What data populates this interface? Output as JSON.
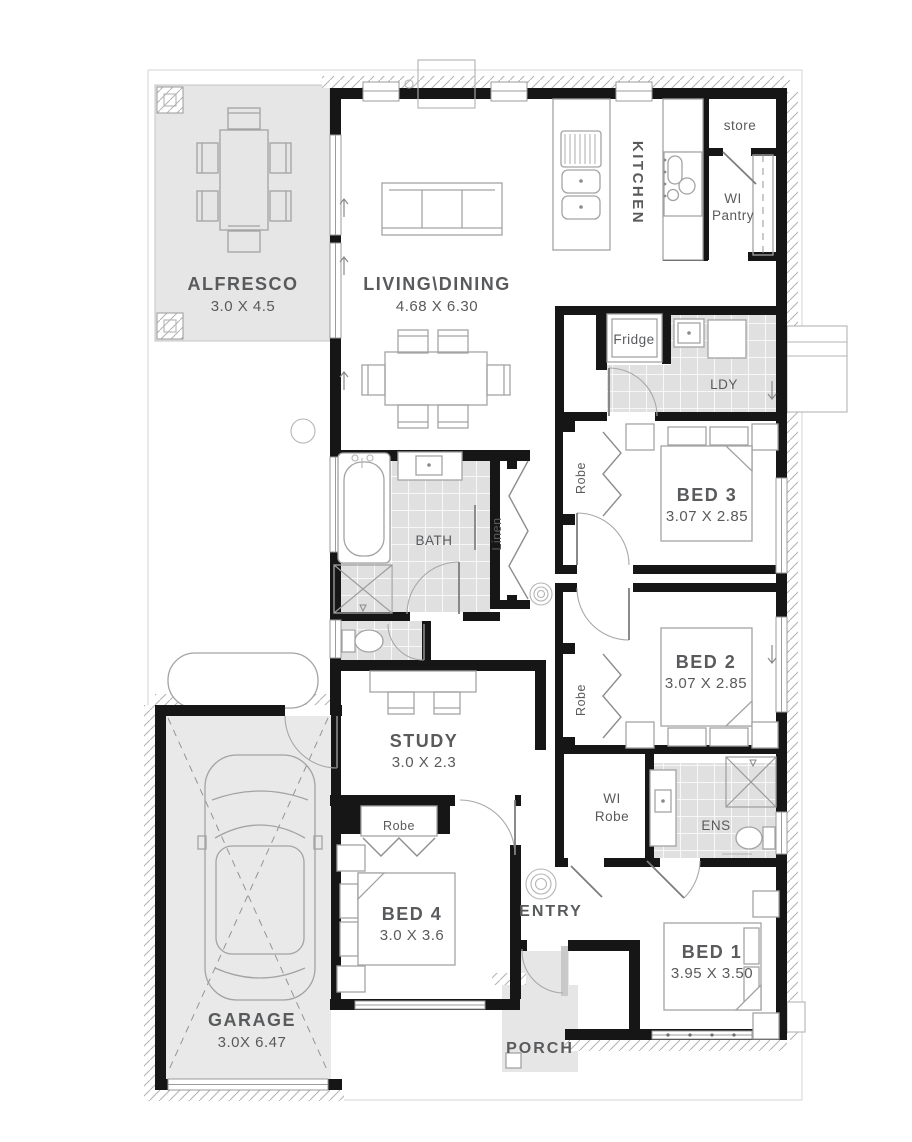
{
  "plan": {
    "rooms": {
      "alfresco": {
        "name": "ALFRESCO",
        "dims": "3.0 X 4.5"
      },
      "living_dining": {
        "name": "LIVING\\DINING",
        "dims": "4.68 X 6.30"
      },
      "kitchen": {
        "name": "KITCHEN"
      },
      "store": {
        "name": "store"
      },
      "wi_pantry": {
        "line1": "WI",
        "line2": "Pantry"
      },
      "fridge": {
        "name": "Fridge"
      },
      "laundry": {
        "name": "LDY"
      },
      "bed3": {
        "name": "BED 3",
        "dims": "3.07 X 2.85",
        "robe": "Robe"
      },
      "bath": {
        "name": "BATH"
      },
      "linen": {
        "name": "Linen"
      },
      "bed2": {
        "name": "BED 2",
        "dims": "3.07 X 2.85",
        "robe": "Robe"
      },
      "study": {
        "name": "STUDY",
        "dims": "3.0 X 2.3"
      },
      "wi_robe": {
        "line1": "WI",
        "line2": "Robe"
      },
      "ens": {
        "name": "ENS"
      },
      "bed4": {
        "name": "BED 4",
        "dims": "3.0 X 3.6",
        "robe": "Robe"
      },
      "entry": {
        "name": "ENTRY"
      },
      "bed1": {
        "name": "BED 1",
        "dims": "3.95 X 3.50"
      },
      "garage": {
        "name": "GARAGE",
        "dims": "3.0X 6.47"
      },
      "porch": {
        "name": "PORCH"
      }
    },
    "colors": {
      "wall": "#161616",
      "area_fill": "#e6e6e6",
      "tile_fill": "#e0e0e0",
      "line": "#9b9b9b",
      "text": "#595a5c"
    }
  }
}
